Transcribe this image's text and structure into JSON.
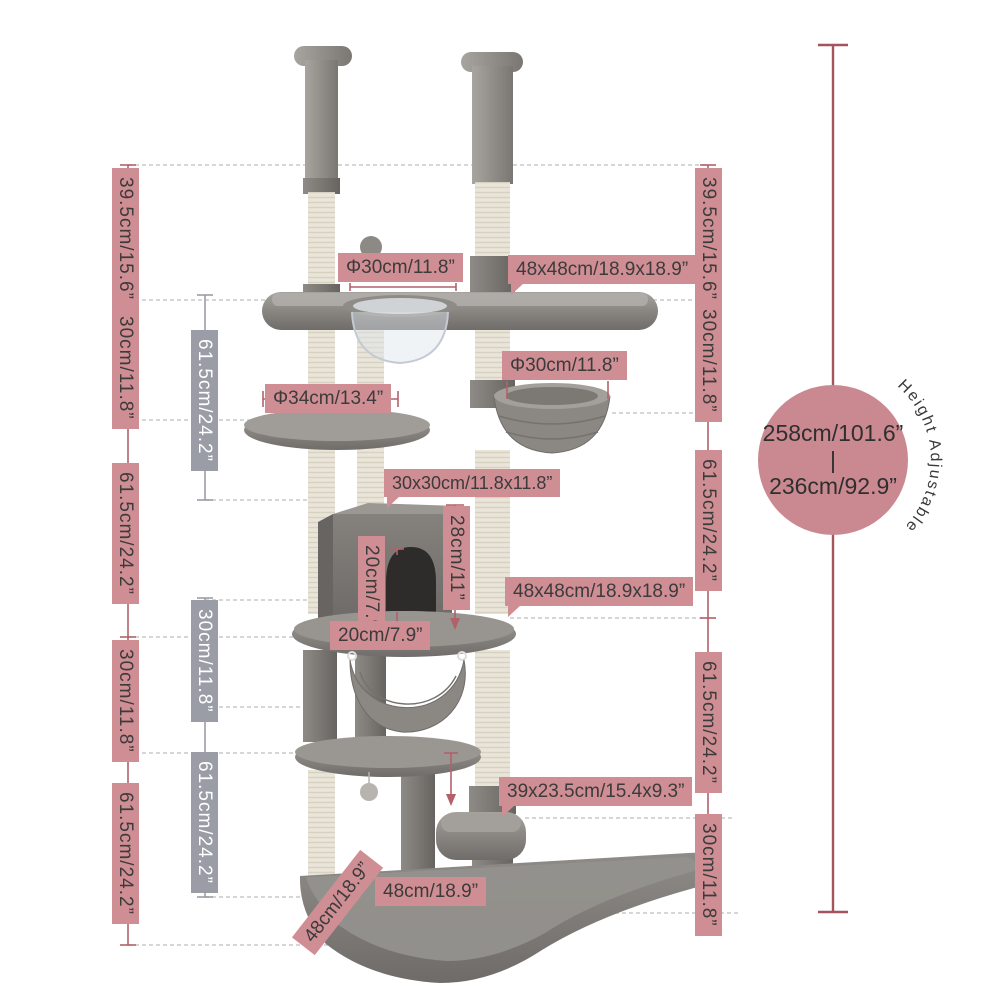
{
  "colors": {
    "label_pink": "#cf8e94",
    "label_gray": "#9b9da6",
    "measure_line": "#b2606a",
    "overall_line": "#a3545c",
    "badge_circle": "#ca8990",
    "text": "#3b3b3b"
  },
  "left_measures": [
    {
      "label": "39.5cm/15.6”"
    },
    {
      "label": "30cm/11.8”"
    },
    {
      "label": "61.5cm/24.2”"
    },
    {
      "label": "30cm/11.8”"
    },
    {
      "label": "61.5cm/24.2”"
    }
  ],
  "inner_measures": [
    {
      "label": "61.5cm/24.2”"
    },
    {
      "label": "30cm/11.8”"
    },
    {
      "label": "61.5cm/24.2”"
    }
  ],
  "right_measures": [
    {
      "label": "39.5cm/15.6”"
    },
    {
      "label": "30cm/11.8”"
    },
    {
      "label": "61.5cm/24.2”"
    },
    {
      "label": "61.5cm/24.2”"
    },
    {
      "label": "30cm/11.8”"
    }
  ],
  "dimension_labels": {
    "top_hole_diameter": "Φ30cm/11.8”",
    "top_platform_size": "48x48cm/18.9x18.9”",
    "round_platform_diameter": "Φ34cm/13.4”",
    "basket_diameter": "Φ30cm/11.8”",
    "condo_size": "30x30cm/11.8x11.8”",
    "condo_height": "28cm/11”",
    "door_height": "20cm/7.9”",
    "condo_depth": "20cm/7.9”",
    "lower_platform_size": "48x48cm/18.9x18.9”",
    "step_size": "39x23.5cm/15.4x9.3”",
    "base_width": "48cm/18.9”",
    "base_depth": "48cm/18.9”"
  },
  "height_badge": {
    "max_height": "258cm/101.6”",
    "separator": "|",
    "min_height": "236cm/92.9”",
    "note": "Height Adjustable"
  }
}
